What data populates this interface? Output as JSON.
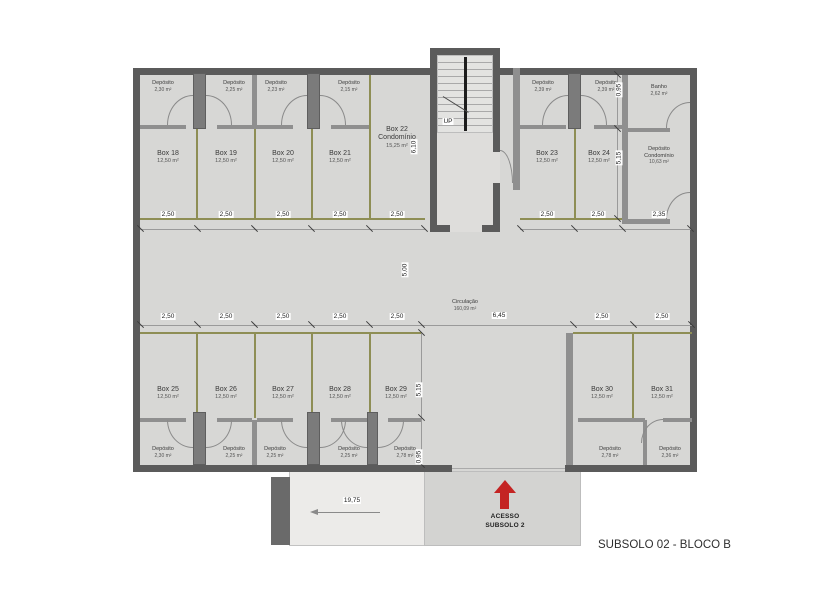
{
  "title": "SUBSOLO 02 - BLOCO B",
  "stairs": {
    "up_label": "UP"
  },
  "access": {
    "line1": "ACESSO",
    "line2": "SUBSOLO 2"
  },
  "circulation": {
    "label": "Circulação",
    "area": "160,09 m²"
  },
  "rooms": {
    "boxes": [
      {
        "label": "Box 18",
        "area": "12,50 m²"
      },
      {
        "label": "Box 19",
        "area": "12,50 m²"
      },
      {
        "label": "Box 20",
        "area": "12,50 m²"
      },
      {
        "label": "Box 21",
        "area": "12,50 m²"
      },
      {
        "label": "Box 23",
        "area": "12,50 m²"
      },
      {
        "label": "Box 24",
        "area": "12,50 m²"
      },
      {
        "label": "Box 25",
        "area": "12,50 m²"
      },
      {
        "label": "Box 26",
        "area": "12,50 m²"
      },
      {
        "label": "Box 27",
        "area": "12,50 m²"
      },
      {
        "label": "Box 28",
        "area": "12,50 m²"
      },
      {
        "label": "Box 29",
        "area": "12,50 m²"
      },
      {
        "label": "Box 30",
        "area": "12,50 m²"
      },
      {
        "label": "Box 31",
        "area": "12,50 m²"
      }
    ],
    "box22": {
      "label": "Box 22",
      "sublabel": "Condomínio",
      "area": "15,25 m²"
    },
    "banho": {
      "label": "Banho",
      "area": "2,62 m²"
    },
    "deposito_condominio": {
      "label": "Depósito",
      "sublabel": "Condomínio",
      "area": "10,63 m²"
    }
  },
  "depositos": {
    "label": "Depósito",
    "top_left_areas": [
      "2,30 m²",
      "2,25 m²",
      "2,23 m²",
      "2,15 m²"
    ],
    "top_right_areas": [
      "2,39 m²",
      "2,39 m²"
    ],
    "bottom_left_areas": [
      "2,30 m²",
      "2,25 m²",
      "2,25 m²",
      "2,25 m²",
      "2,78 m²"
    ],
    "bottom_right_areas": [
      "2,78 m²",
      "2,36 m²"
    ]
  },
  "dimensions": {
    "bay_width": "2,50",
    "right_bay_width": "2,35",
    "box22_depth": "6,10",
    "box_depth": "5,15",
    "deposito_depth": "0,95",
    "circulation_depth": "5,00",
    "circulation_width": "6,45",
    "ramp_length": "19,75"
  },
  "colors": {
    "floor": "#d7d7d5",
    "exterior_wall": "#5b5b5b",
    "partition_wall": "#8f8f8f",
    "box_separator": "#8e8e55",
    "ramp": "#ecebe9",
    "access_area": "#d3d3d1",
    "access_arrow": "#c42423"
  }
}
